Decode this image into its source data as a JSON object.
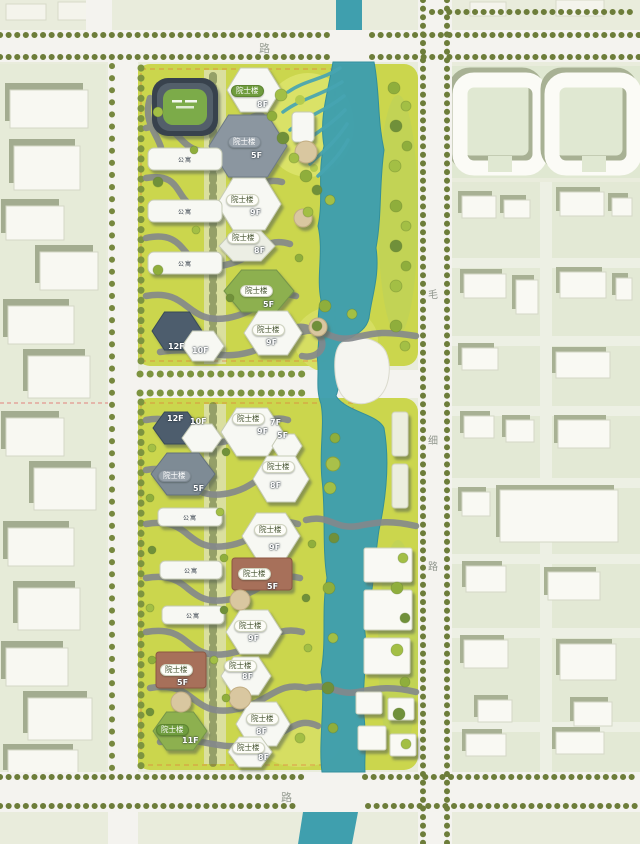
{
  "plan": {
    "type": "architectural-master-plan",
    "palette": {
      "river": "#3f9fae",
      "site_lawn": "#cbd64d",
      "road": "#f4f3ef",
      "context": "#e9ecdc",
      "path_gray": "#84888c",
      "badge_green": "#6f9c3e",
      "building_white": "#f7f8f3",
      "building_dark": "#4d5d6d",
      "building_gray": "#8b96a0",
      "building_green": "#8db050",
      "building_brown": "#a7705a"
    }
  },
  "roads": {
    "top_label": "路",
    "bottom_label": "路",
    "right_vertical_labels": [
      "毛",
      "细",
      "路"
    ]
  },
  "site": {
    "building_type_label": "院士楼",
    "apartment_label": "公寓",
    "buildings": [
      {
        "label": "院士楼",
        "floor": "8F",
        "style": "green"
      },
      {
        "label": "院士楼",
        "floor": "5F",
        "style": "gray"
      },
      {
        "label": "院士楼",
        "floor": "9F",
        "style": "white"
      },
      {
        "label": "院士楼",
        "floor": "8F",
        "style": "white"
      },
      {
        "label": "院士楼",
        "floor": "5F",
        "style": "white"
      },
      {
        "label": "院士楼",
        "floor": "9F",
        "style": "white"
      },
      {
        "label": "院士楼",
        "floor": "9F",
        "style": "white"
      },
      {
        "label": "院士楼",
        "floor": "5F",
        "style": "gray"
      },
      {
        "label": "院士楼",
        "floor": "8F",
        "style": "white"
      },
      {
        "label": "院士楼",
        "floor": "9F",
        "style": "white"
      },
      {
        "label": "院士楼",
        "floor": "5F",
        "style": "white"
      },
      {
        "label": "院士楼",
        "floor": "9F",
        "style": "white"
      },
      {
        "label": "院士楼",
        "floor": "5F",
        "style": "white"
      },
      {
        "label": "院士楼",
        "floor": "8F",
        "style": "white"
      },
      {
        "label": "院士楼",
        "floor": "11F",
        "style": "green"
      },
      {
        "label": "院士楼",
        "floor": "8F",
        "style": "white"
      },
      {
        "label": "院士楼",
        "floor": "8F",
        "style": "white"
      }
    ],
    "standalone_floors": [
      "12F",
      "10F",
      "12F",
      "10F",
      "7F",
      "5F"
    ]
  }
}
